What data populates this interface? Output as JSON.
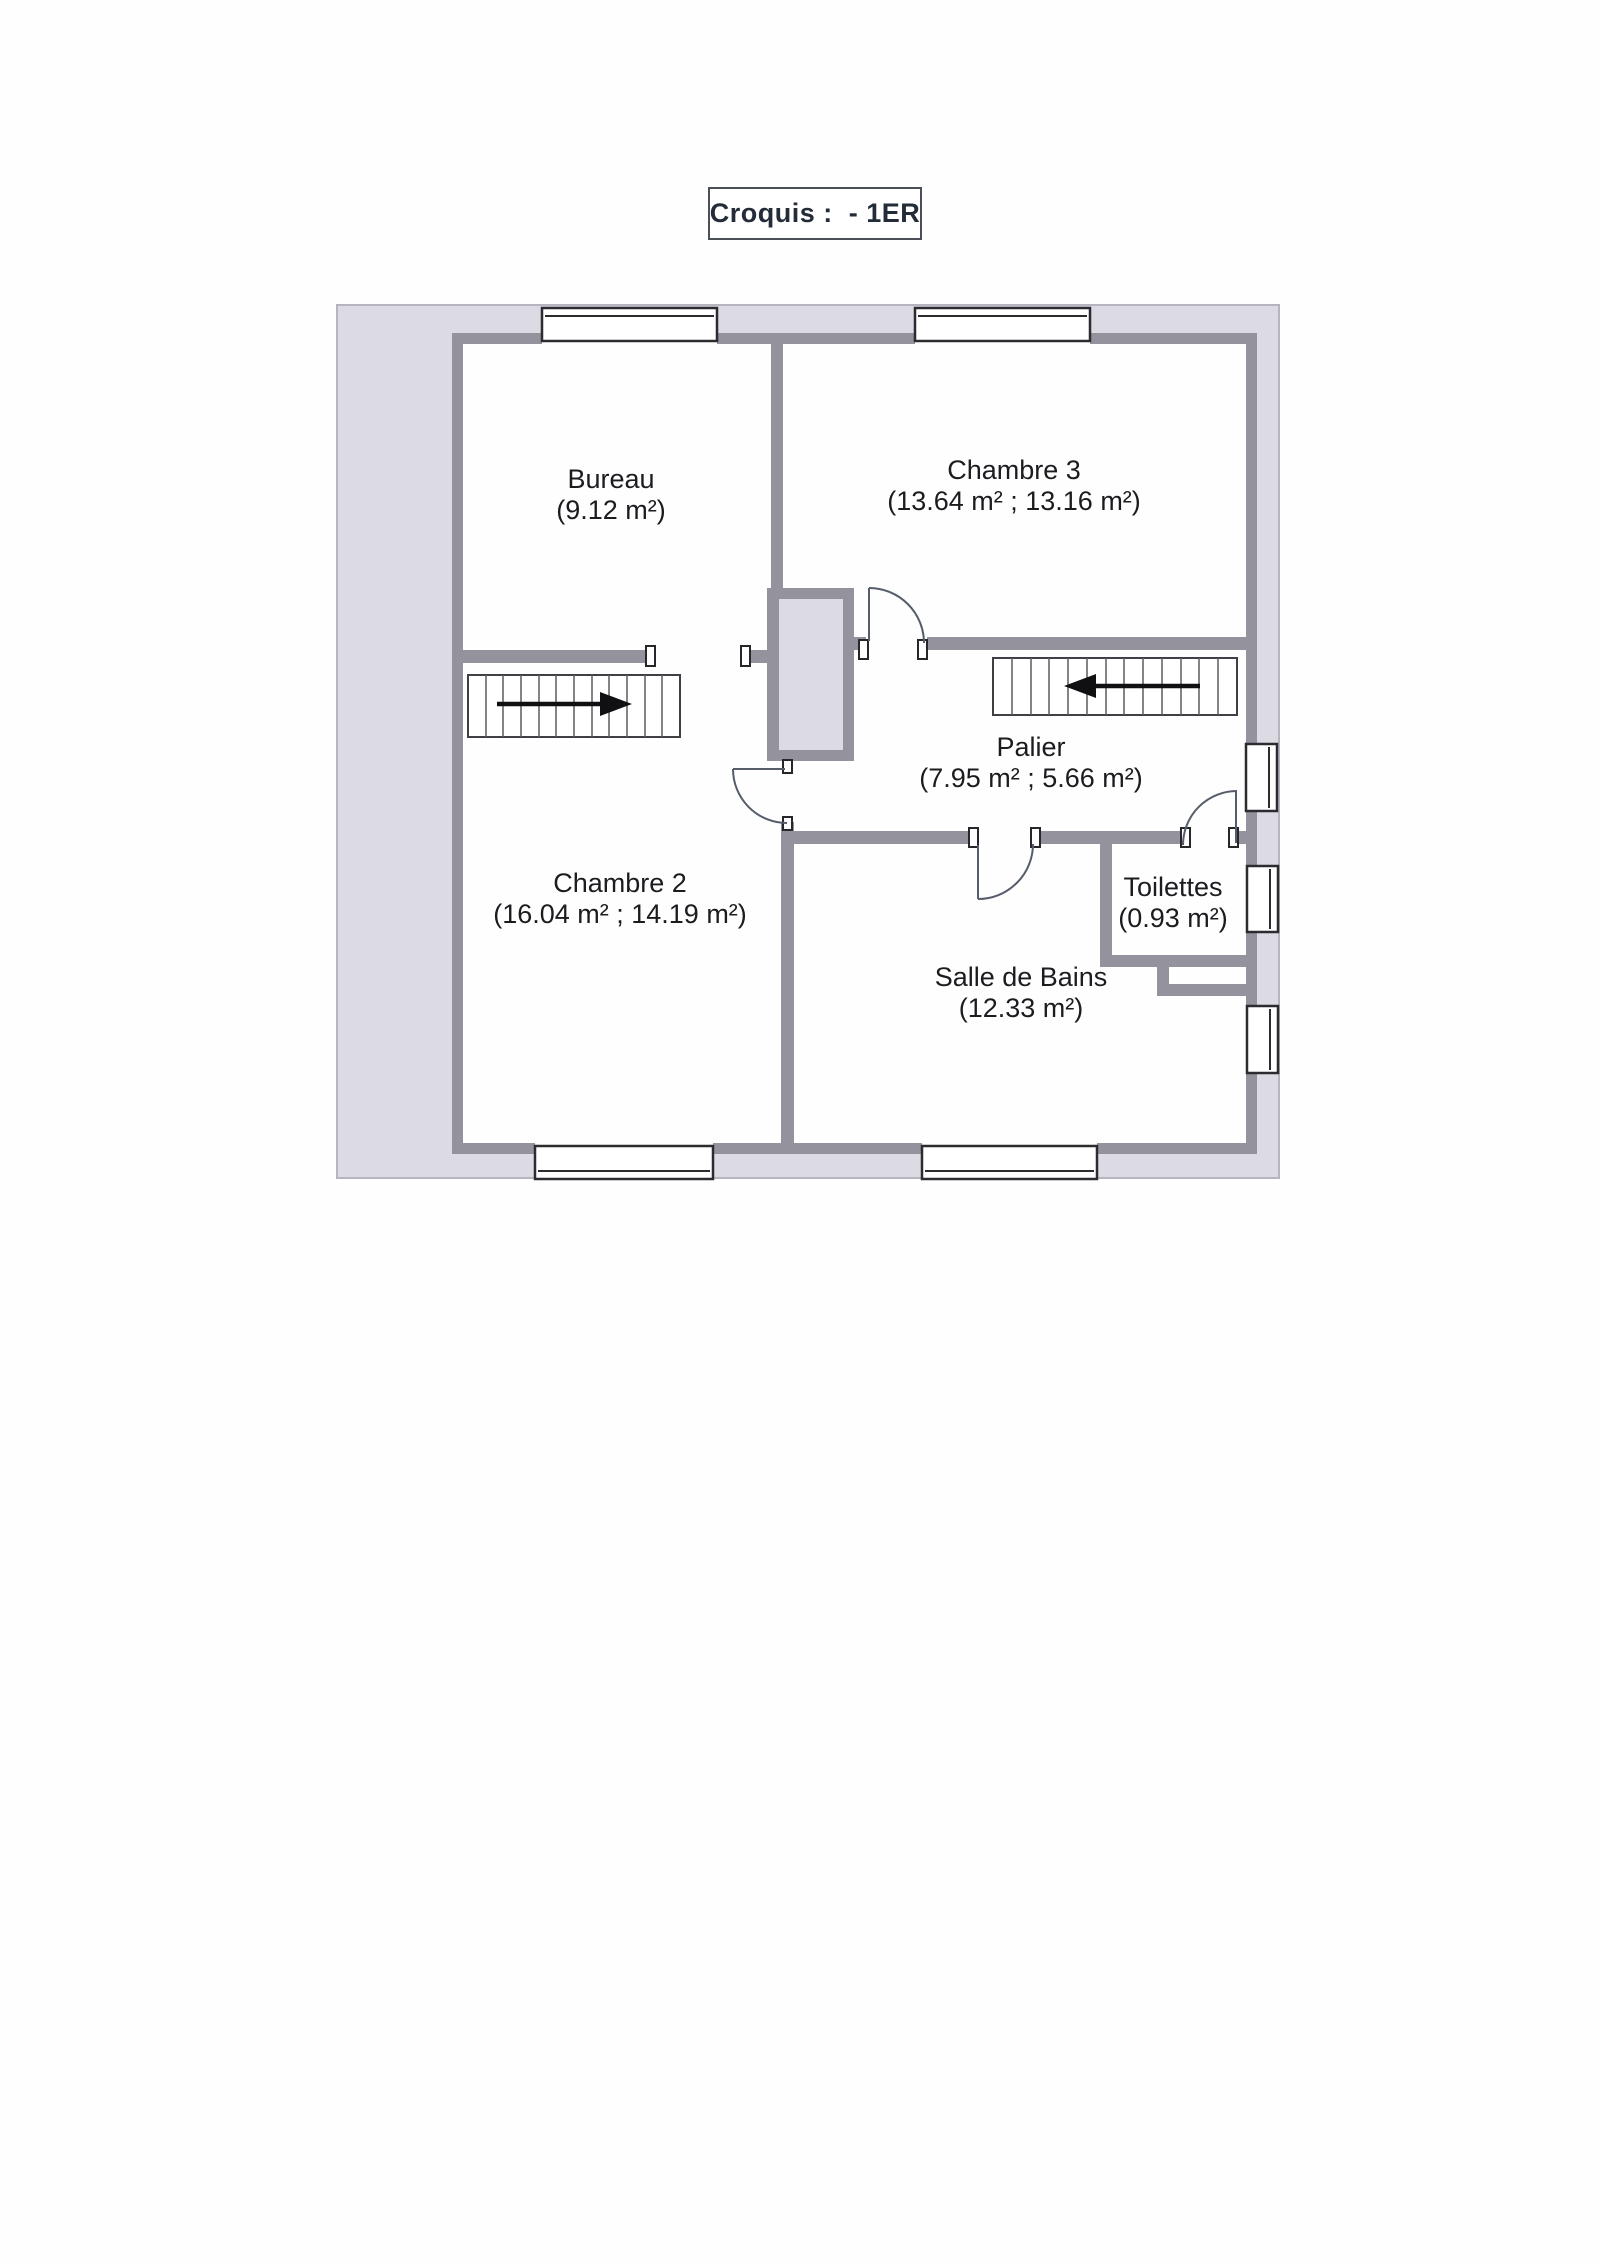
{
  "title": "Croquis :  - 1ER",
  "rooms": [
    {
      "name": "Bureau",
      "area": "(9.12 m²)"
    },
    {
      "name": "Chambre 3",
      "area": "(13.64 m² ; 13.16 m²)"
    },
    {
      "name": "Palier",
      "area": "(7.95 m² ; 5.66 m²)"
    },
    {
      "name": "Chambre 2",
      "area": "(16.04 m² ; 14.19 m²)"
    },
    {
      "name": "Salle de Bains",
      "area": "(12.33 m²)"
    },
    {
      "name": "Toilettes",
      "area": "(0.93 m²)"
    }
  ],
  "stairs": [
    {
      "location": "left",
      "arrow_direction": "right"
    },
    {
      "location": "right",
      "arrow_direction": "left"
    }
  ],
  "colors": {
    "paper": "#fefefe",
    "exterior_band": "#dcdbe3",
    "wall": "#94929c",
    "window_frame": "#2b2b30",
    "door_line": "#565d6a",
    "label_text": "#1c1c20",
    "title_text": "#232c38"
  }
}
